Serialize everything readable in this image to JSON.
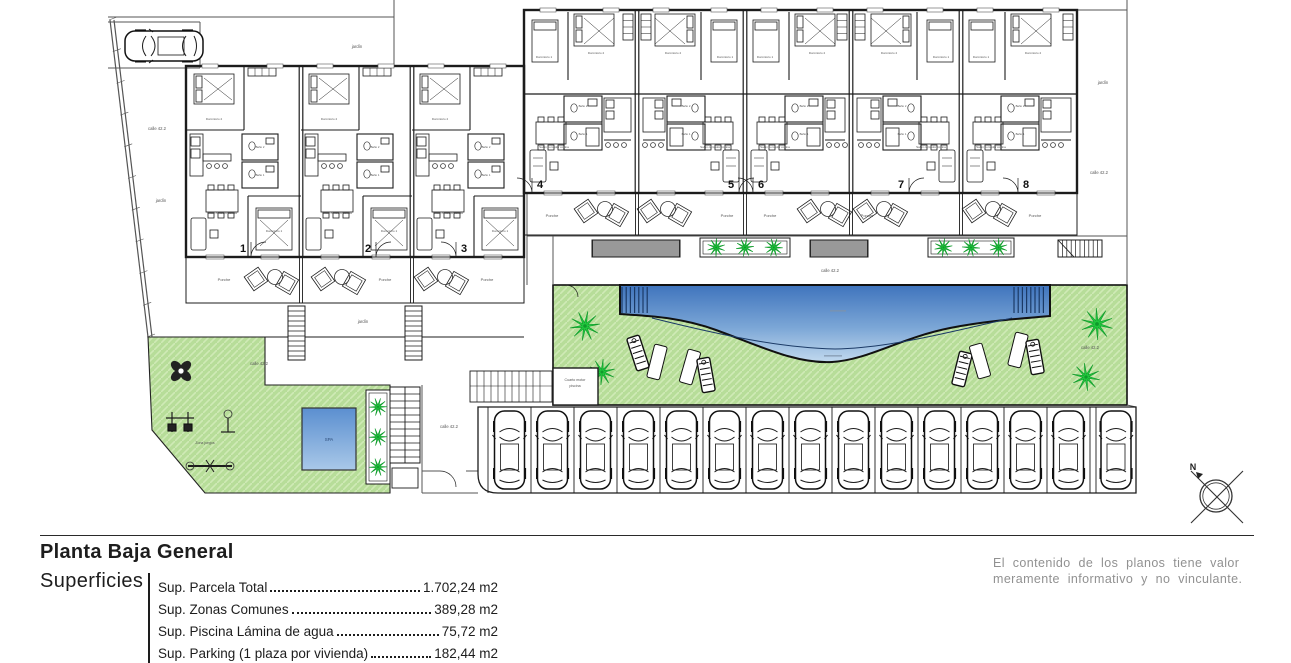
{
  "title_block": {
    "title": "Planta Baja General",
    "section_label": "Superficies",
    "items": [
      {
        "label": "Sup. Parcela Total",
        "value": "1.702,24 m2"
      },
      {
        "label": "Sup. Zonas Comunes",
        "value": "389,28 m2"
      },
      {
        "label": "Sup. Piscina Lámina de agua",
        "value": "75,72 m2"
      },
      {
        "label": "Sup. Parking (1 plaza por vivienda)",
        "value": "182,44 m2"
      }
    ]
  },
  "disclaimer": {
    "line1": "El contenido de los planos tiene valor",
    "line2": "meramente informativo y no vinculante."
  },
  "plan": {
    "unit_numbers": [
      {
        "n": "1",
        "x": 243,
        "y": 252,
        "dir": "r"
      },
      {
        "n": "2",
        "x": 368,
        "y": 252,
        "dir": "r"
      },
      {
        "n": "3",
        "x": 464,
        "y": 252,
        "dir": "l"
      },
      {
        "n": "4",
        "x": 540,
        "y": 188,
        "dir": "l"
      },
      {
        "n": "5",
        "x": 731,
        "y": 188,
        "dir": "r"
      },
      {
        "n": "6",
        "x": 761,
        "y": 188,
        "dir": "l"
      },
      {
        "n": "7",
        "x": 901,
        "y": 188,
        "dir": "r"
      },
      {
        "n": "8",
        "x": 1026,
        "y": 188,
        "dir": "l"
      }
    ],
    "room_labels": {
      "living": "Salón comedor cocina",
      "bed1": "Dormitorio 1",
      "bed2": "Dormitorio 2",
      "bath1": "Baño 1",
      "bath2": "Baño 2"
    },
    "porch_label": "Porche",
    "porch_label_positions": [
      [
        224,
        281
      ],
      [
        385,
        281
      ],
      [
        487,
        281
      ],
      [
        552,
        217
      ],
      [
        727,
        217
      ],
      [
        770,
        217
      ],
      [
        867,
        217
      ],
      [
        1035,
        217
      ]
    ],
    "street_garden_labels": [
      {
        "t": "jardín",
        "x": 357,
        "y": 48
      },
      {
        "t": "calle 42.2",
        "x": 157,
        "y": 130
      },
      {
        "t": "jardín",
        "x": 161,
        "y": 202
      },
      {
        "t": "jardín",
        "x": 363,
        "y": 323
      },
      {
        "t": "calle 42.2",
        "x": 259,
        "y": 365
      },
      {
        "t": "calle 42.2",
        "x": 830,
        "y": 272
      },
      {
        "t": "jardín",
        "x": 1103,
        "y": 84
      },
      {
        "t": "calle 42.2",
        "x": 1099,
        "y": 174
      },
      {
        "t": "calle 42.2",
        "x": 1090,
        "y": 349
      },
      {
        "t": "calle 42.2",
        "x": 449,
        "y": 428
      }
    ],
    "spa_label": "SPA",
    "pool_room": {
      "line1": "Cuarto motor",
      "line2": "piscina"
    },
    "playground_label": "Zona juegos",
    "compass_north_label": "N",
    "parking": {
      "spaces": 15
    },
    "colors": {
      "wall": "#1c1c1c",
      "thin": "#333333",
      "boundary": "#555555",
      "lawn": "#b7dd99",
      "lawn_hatch": "#cfeab6",
      "palm": "#22c93e",
      "palm_dark": "#0f9b2b",
      "pool_top": "#3f74bd",
      "pool_low": "#c2d9ee",
      "pool_line": "#1b3a66",
      "disclaimer_text": "#919191",
      "label_text": "#555555"
    }
  }
}
